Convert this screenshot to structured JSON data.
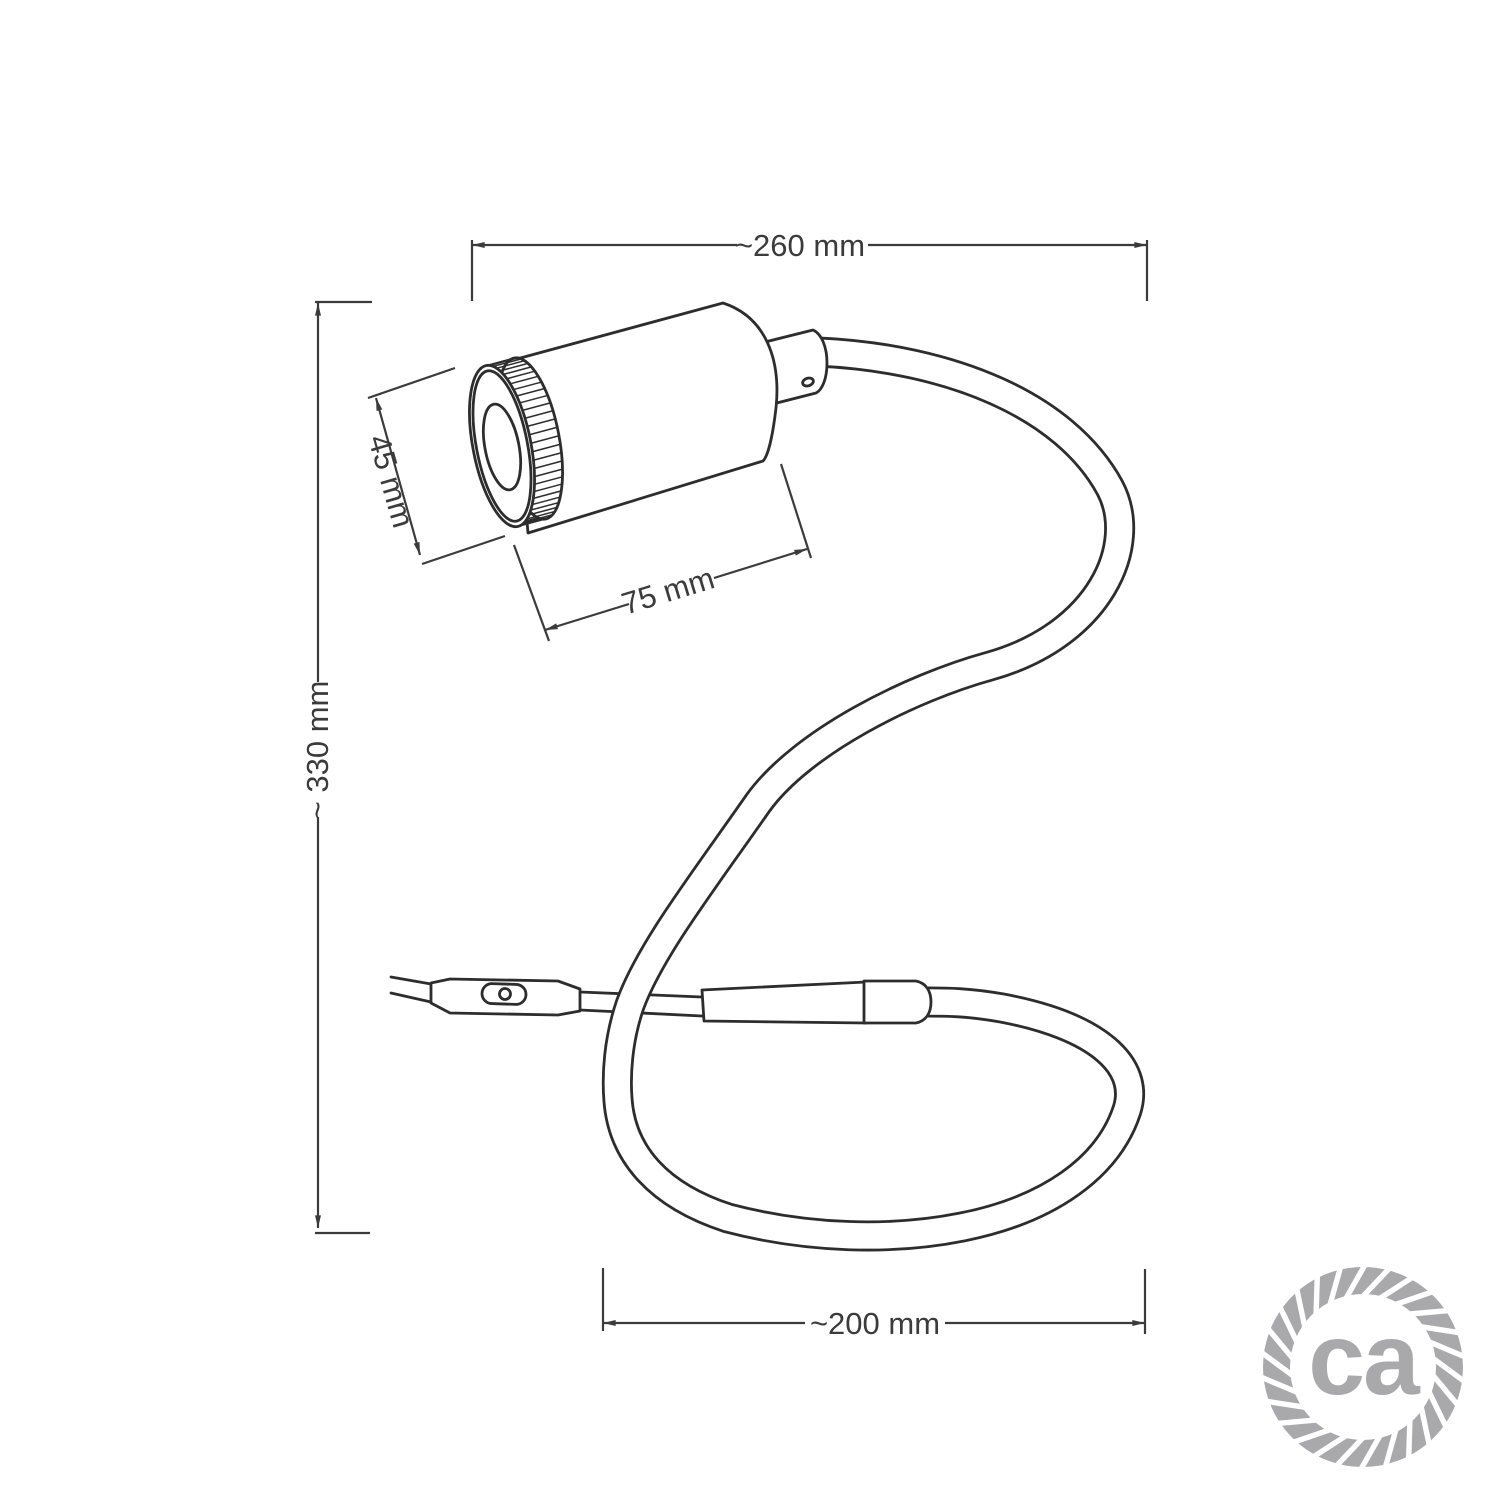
{
  "diagram": {
    "kind": "technical-dimension-drawing",
    "subject": "gooseneck-spotlight-table-lamp"
  },
  "dimensions": {
    "top_width": "~260 mm",
    "left_height": "~ 330 mm",
    "head_diameter": "45 mm",
    "head_length": "75 mm",
    "bottom_width": "~200 mm"
  },
  "logo": {
    "text": "ca"
  },
  "colors": {
    "line": "#2d2d2d",
    "dim": "#3b3b3b",
    "logo": "#a9a9ac",
    "background": "#ffffff"
  }
}
